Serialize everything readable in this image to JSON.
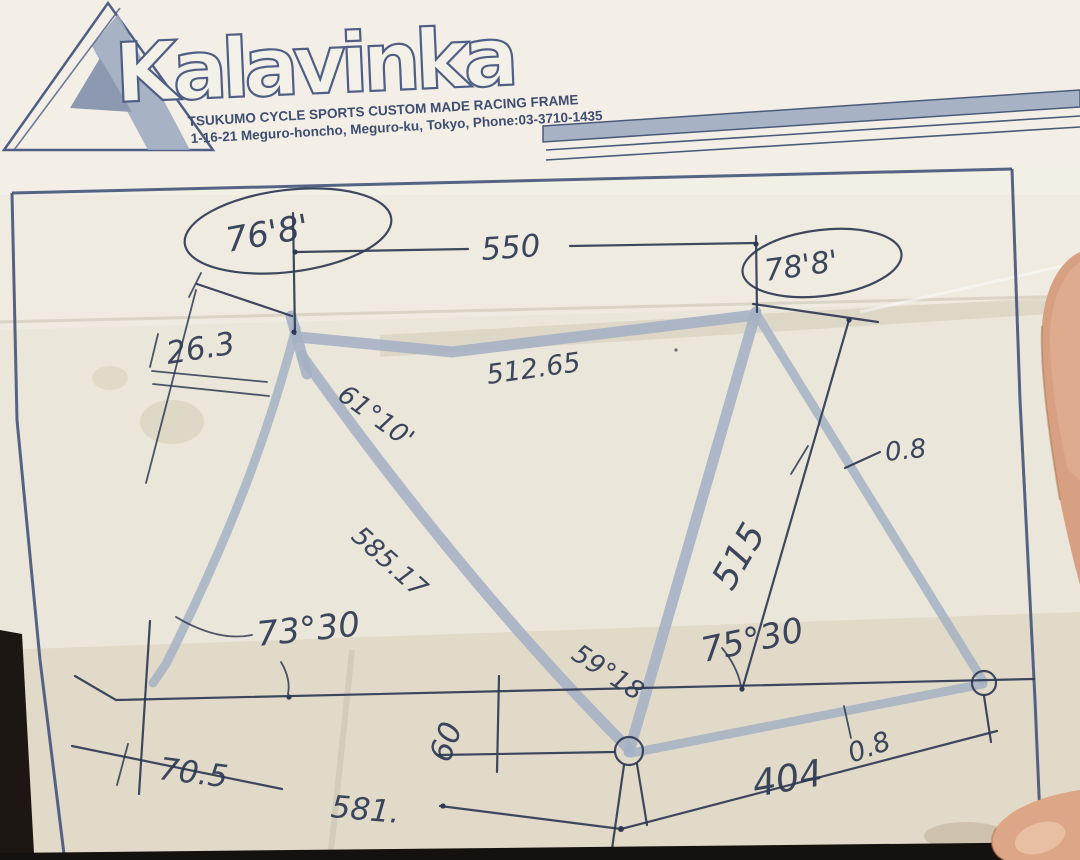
{
  "header": {
    "brand": "Kalavinka",
    "tagline": "TSUKUMO CYCLE SPORTS CUSTOM MADE RACING FRAME",
    "address": "1-16-21 Meguro-honcho, Meguro-ku, Tokyo, Phone:03-3710-1435"
  },
  "measurements": {
    "head_angle": "76'8'",
    "top_tube": "550",
    "seat_angle": "78'8'",
    "head_tube_extension": "26.3",
    "down_tube_angle": "61°10'",
    "top_tube_horizontal": "512.65",
    "seat_offset": "0.8",
    "down_tube_length": "585.17",
    "fork_angle": "73°30",
    "seat_tube_length": "515",
    "seat_tube_angle": "75°30",
    "bb_angle": "59°18",
    "fork_offset": "70.5",
    "bb_drop": "60",
    "front_center": "581.",
    "chainstay_length": "404",
    "rear_offset": "0.8"
  }
}
